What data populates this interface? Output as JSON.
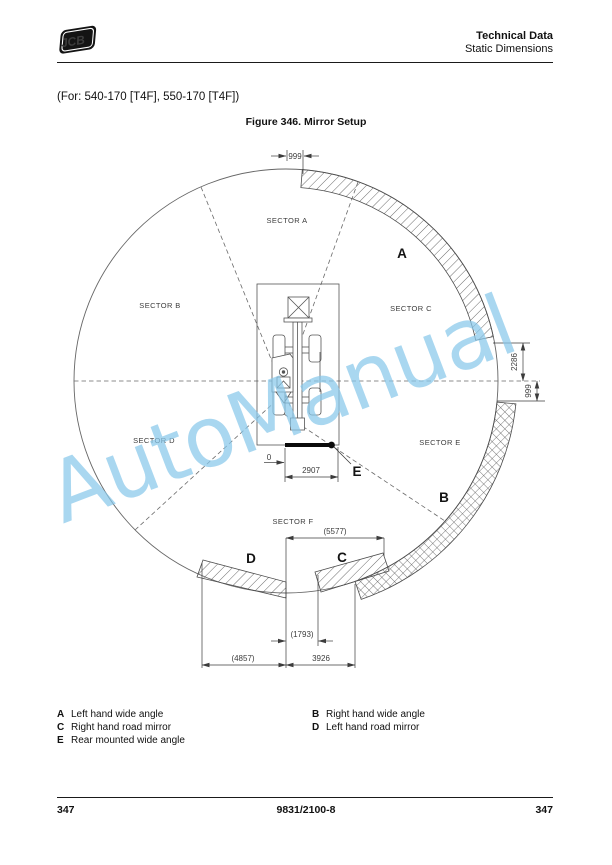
{
  "header": {
    "logo_text": "JCB",
    "title": "Technical Data",
    "subtitle": "Static Dimensions"
  },
  "intro": {
    "applicability": "(For: 540-170 [T4F], 550-170 [T4F])",
    "figure_caption": "Figure 346. Mirror Setup"
  },
  "diagram": {
    "watermark": "AutoManual",
    "sector_labels": {
      "a": "SECTOR A",
      "b": "SECTOR B",
      "c": "SECTOR C",
      "d": "SECTOR D",
      "e": "SECTOR E",
      "f": "SECTOR F"
    },
    "mirror_keys": {
      "a": "A",
      "b": "B",
      "c": "C",
      "d": "D",
      "e": "E"
    },
    "dimensions": {
      "top_offset": "999",
      "right_upper": "2286",
      "right_lower": "999",
      "zero_ref": "0",
      "rear_width": "2907",
      "span_total": "(5577)",
      "gap": "(1793)",
      "left_total": "(4857)",
      "right_total": "3926"
    }
  },
  "legend": {
    "items": [
      {
        "key": "A",
        "label": "Left hand wide angle"
      },
      {
        "key": "B",
        "label": "Right hand wide angle"
      },
      {
        "key": "C",
        "label": "Right hand road mirror"
      },
      {
        "key": "D",
        "label": "Left hand road mirror"
      },
      {
        "key": "E",
        "label": "Rear mounted wide angle"
      }
    ]
  },
  "footer": {
    "page_left": "347",
    "doc_number": "9831/2100-8",
    "page_right": "347"
  }
}
